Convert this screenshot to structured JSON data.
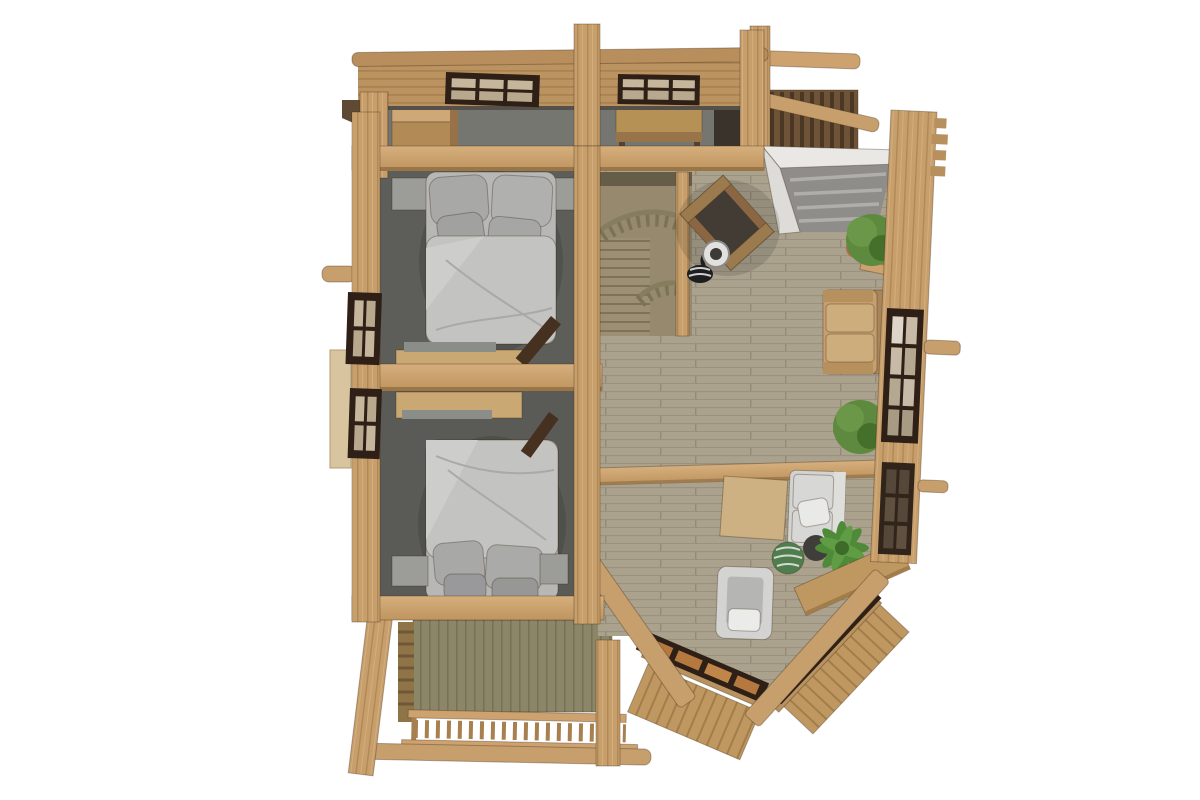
{
  "scene": {
    "type": "3d-floor-plan-top-view",
    "description": "Top-down 3D render of the upper floor of a wooden log cabin",
    "rooms": [
      {
        "name": "north-hall-strip",
        "floor": "dark gray",
        "items": [
          "wardrobe",
          "desk",
          "two-windows"
        ]
      },
      {
        "name": "bedroom-1",
        "floor": "dark gray carpet",
        "items": [
          "double-bed",
          "pillows",
          "nightstand-left",
          "nightstand-right",
          "sideboard",
          "open-door"
        ]
      },
      {
        "name": "bedroom-2",
        "floor": "dark gray carpet",
        "items": [
          "double-bed",
          "pillows",
          "nightstand-left",
          "nightstand-right",
          "dresser",
          "open-door",
          "wall-tv"
        ]
      },
      {
        "name": "living-area",
        "floor": "wood planks",
        "items": [
          "staircase-with-curved-railing",
          "wooden-armchair",
          "floor-lamp",
          "skylight-void",
          "plant-pot-1",
          "plant-pot-2",
          "tan-sofa",
          "cross-beam",
          "rug",
          "white-sofa",
          "palm-plant",
          "green-pouf",
          "white-armchair",
          "bay-benches"
        ]
      },
      {
        "name": "south-balcony",
        "items": [
          "green-paneled-wall",
          "baluster-railing",
          "posts",
          "outer-log"
        ]
      },
      {
        "name": "northeast-balcony",
        "items": [
          "slat-railing",
          "pergola-logs",
          "post"
        ]
      },
      {
        "name": "bay-corner",
        "items": [
          "bay-window-band-a",
          "bay-window-band-b",
          "angled-decking",
          "diagonal-roof-beams"
        ]
      }
    ]
  },
  "colors": {
    "bg": "#ffffff",
    "woodBeam": "#cda26f",
    "woodBeamDark": "#a07c4e",
    "woodPost": "#c79f6d",
    "wallPlank": "#bb9361",
    "floorPlank": "#aba28e",
    "grayFloor": "#75766f",
    "carpet": "#5d5e59",
    "carpet2": "#5a5b56",
    "frameDark": "#2e2016",
    "glass": "#c6b69b",
    "glassAmber": "#b5793f",
    "glassDark": "#55483a",
    "bedBase": "#b7b7b5",
    "duvet": "#c3c3c1",
    "duvetHi": "#cdcdcb",
    "pillow": "#a8a8a6",
    "nightstand": "#9c9c99",
    "sideboard": "#c9a873",
    "grayStrip": "#8b8d89",
    "whiteSofa": "#d3d3d1",
    "whiteTrim": "#e9e8e5",
    "tanSofa": "#c59f70",
    "tanSofaDark": "#b6915e",
    "leaf": "#5d8a3e",
    "leafDark": "#44702c",
    "palm": "#4f8a38",
    "pot": "#b06a4a",
    "potDark": "#3f3e3a",
    "pouf": "#4e7d4e",
    "rug": "#cdb183",
    "lamp": "#1e1e20",
    "lampShade": "#e2e1dd",
    "doorDark": "#46301f",
    "tvDark": "#26211b",
    "skylightSlat": "#8f8d89",
    "greenWall": "#8c8669",
    "stairFloor": "#96896d",
    "stairDark": "#665d49",
    "railOlive": "#7c7254",
    "tread": "#9c8f73",
    "deck": "#bf9760",
    "darkSlat": "#6f5336",
    "shutter": "#d8c49e"
  }
}
